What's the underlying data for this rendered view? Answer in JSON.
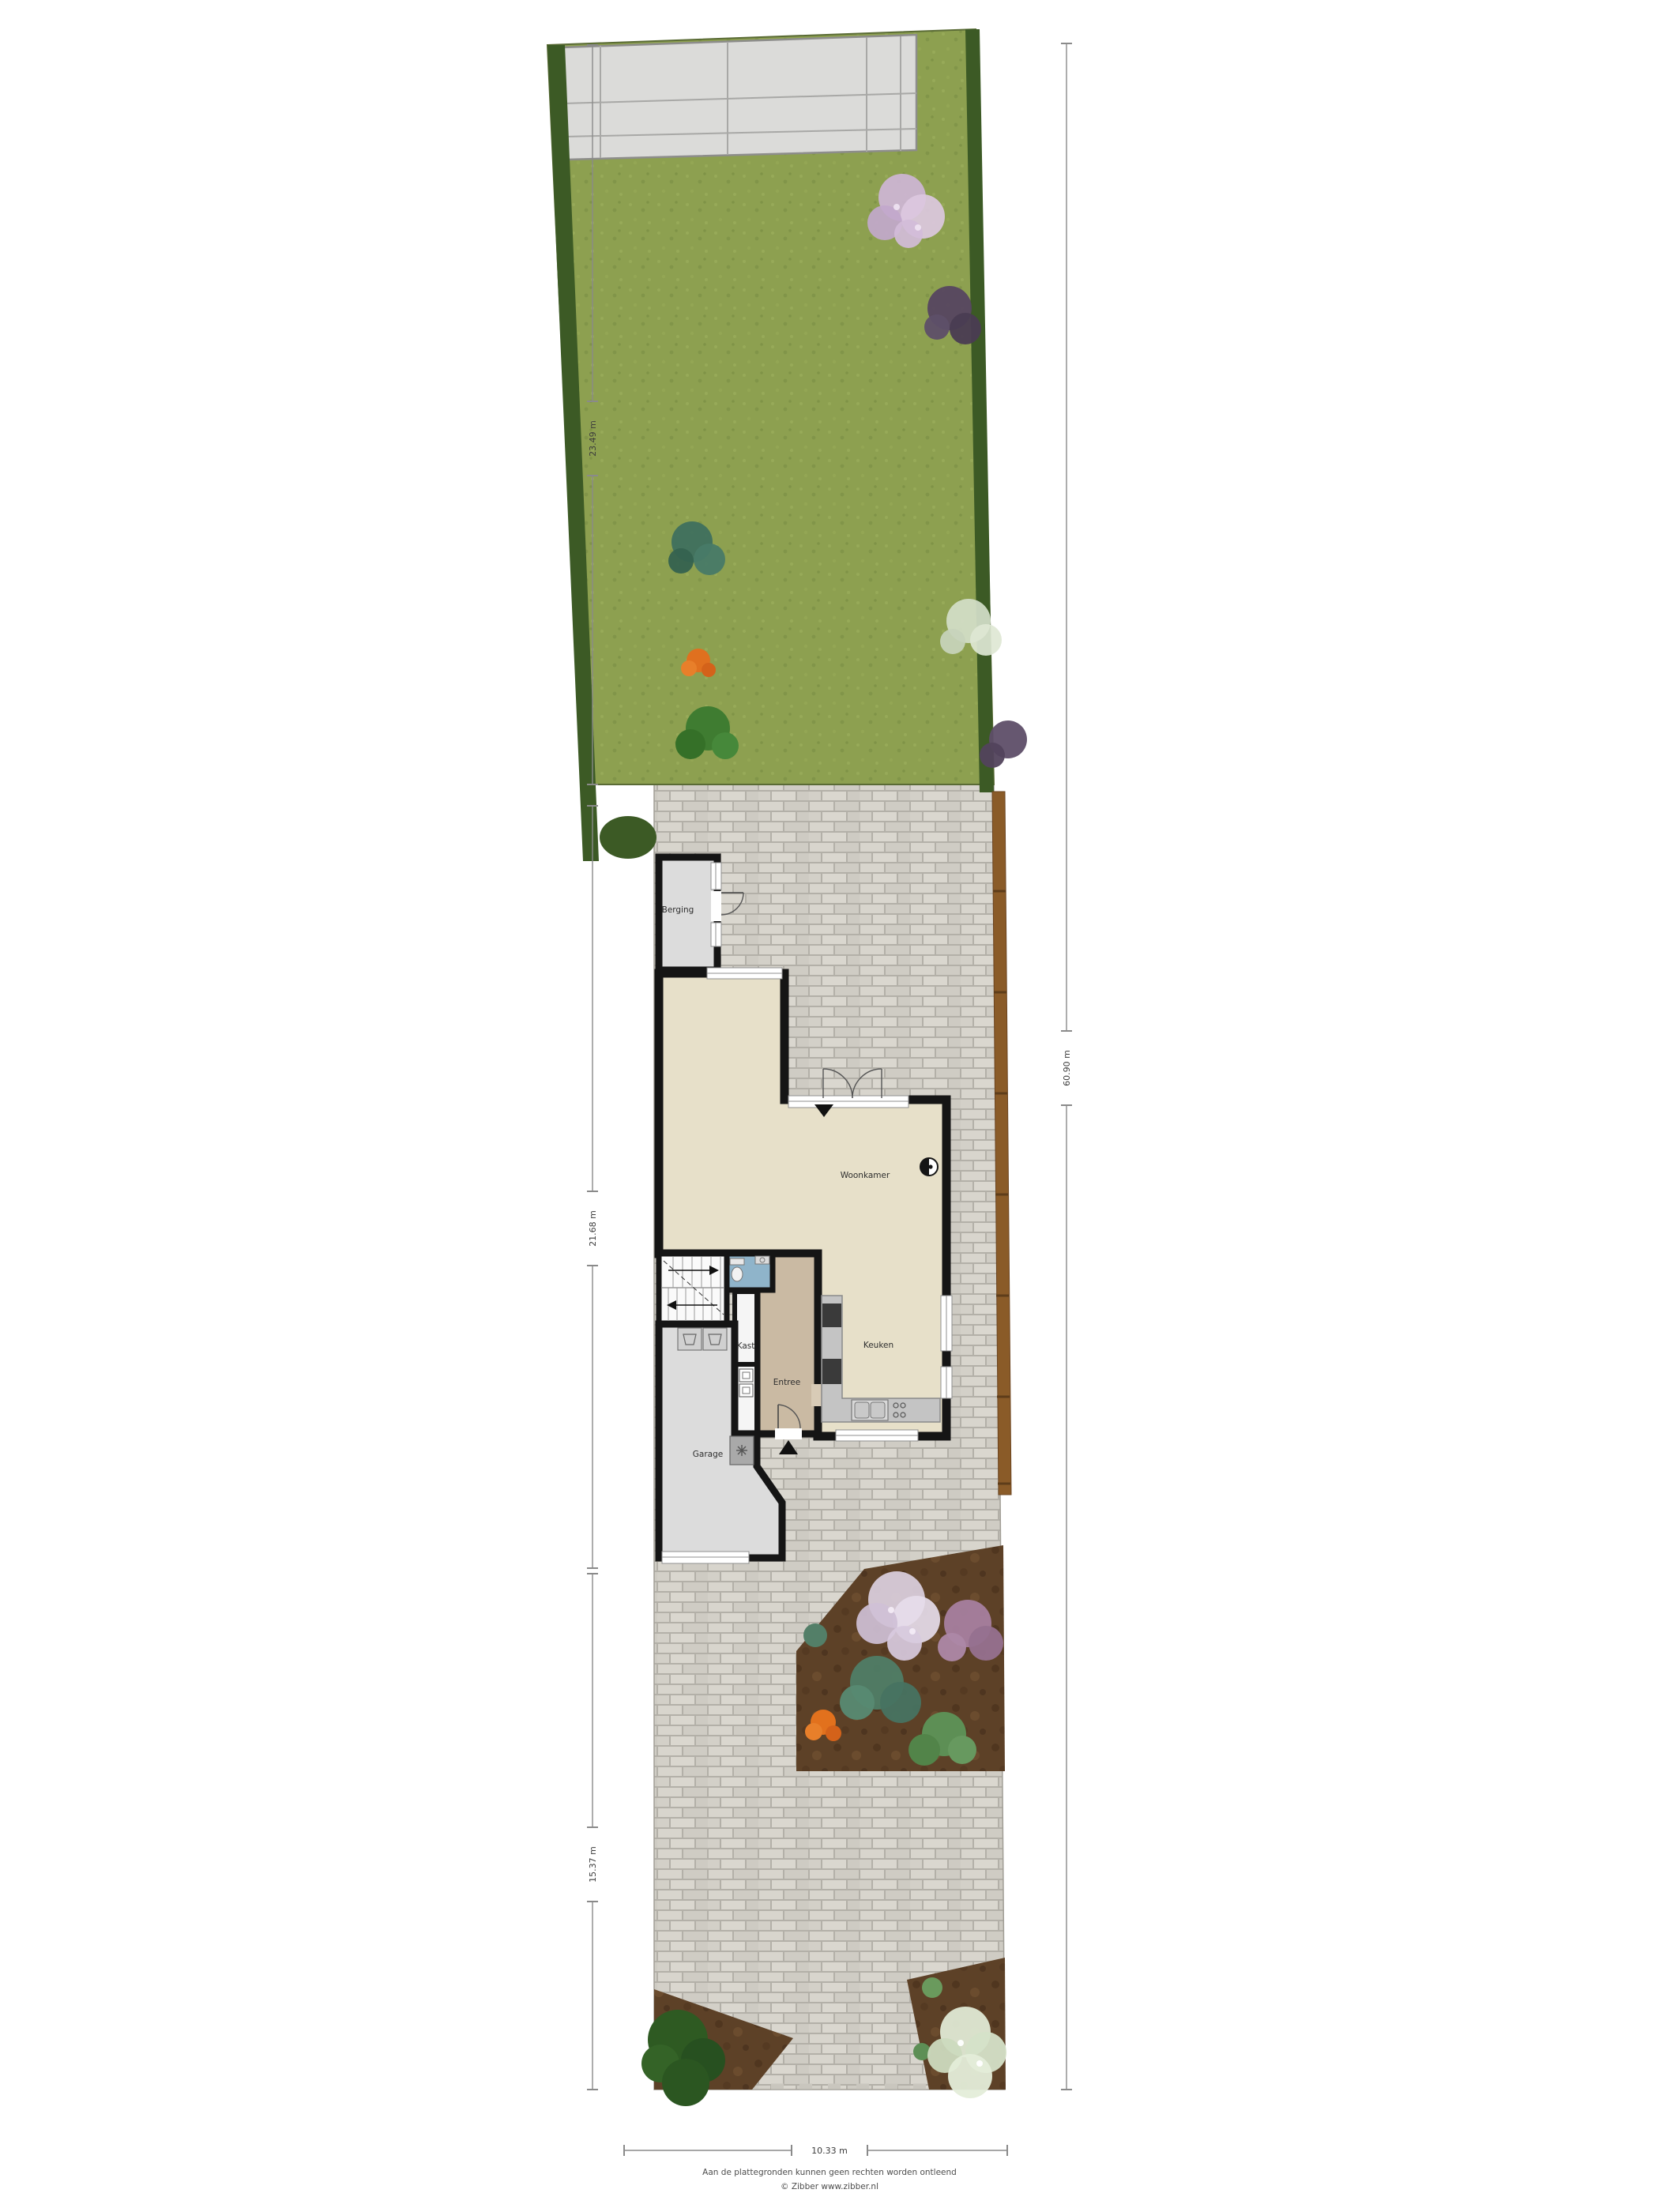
{
  "plan": {
    "rooms": {
      "berging": "Berging",
      "woonkamer": "Woonkamer",
      "keuken": "Keuken",
      "entree": "Entree",
      "kast": "Kast",
      "garage": "Garage"
    },
    "dimensions": {
      "left_garden": "23.49 m",
      "left_house": "21.68 m",
      "left_front": "15.37 m",
      "right_total": "60.90 m",
      "bottom_width": "10.33 m"
    },
    "footer": {
      "disclaimer": "Aan de plattegronden kunnen geen rechten worden ontleend",
      "credit": "© Zibber www.zibber.nl"
    },
    "icons": [
      "entrance-arrow",
      "toilet",
      "hand-basin",
      "washer",
      "dryer",
      "boiler",
      "fireplace",
      "kitchen-sink",
      "cooktop",
      "stairs-arrow"
    ],
    "colors": {
      "lawn": "#8EA355",
      "hedge": "#3C5A25",
      "paving_brick": "#D5D2CA",
      "slab": "#DBDBD9",
      "soil": "#5D4127",
      "fence": "#8A5B28",
      "wall": "#151515",
      "floor_living": "#E7E0C9",
      "floor_entree": "#CABAA3",
      "floor_utility": "#DCDCDC",
      "floor_toilet": "#8FB4CA"
    }
  }
}
